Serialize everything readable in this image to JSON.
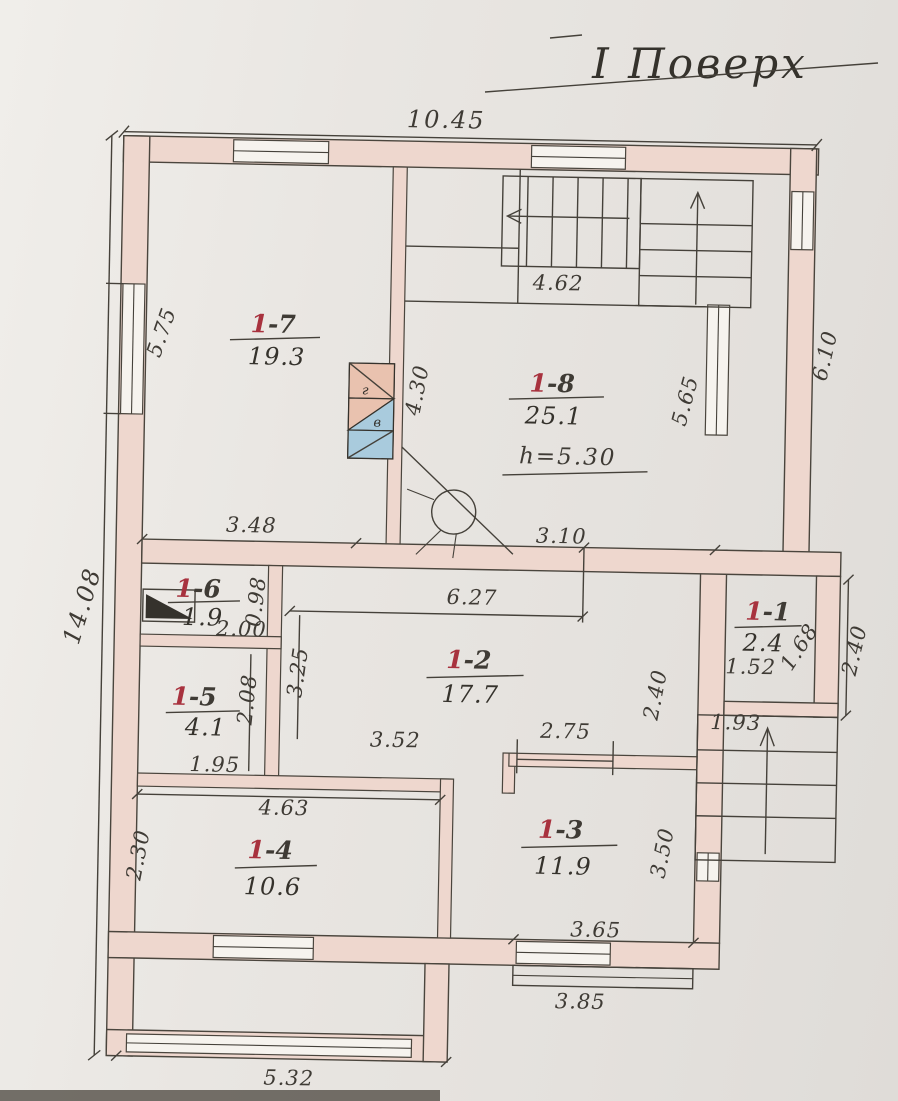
{
  "title": "І Поверх",
  "colors": {
    "paper": "#e9e6e2",
    "wall_fill": "#eed7ce",
    "ink": "#3f3b35",
    "room_number_red": "#a8323e",
    "flue_pink": "#e9c2af",
    "flue_blue": "#a9cbdd"
  },
  "rooms": [
    {
      "name": "room-1-7",
      "num_red": "1",
      "num_rest": "-7",
      "area": "19.3"
    },
    {
      "name": "room-1-8",
      "num_red": "1",
      "num_rest": "-8",
      "area": "25.1",
      "note": "h=5.30"
    },
    {
      "name": "room-1-6",
      "num_red": "1",
      "num_rest": "-6",
      "area": "1.9"
    },
    {
      "name": "room-1-2",
      "num_red": "1",
      "num_rest": "-2",
      "area": "17.7"
    },
    {
      "name": "room-1-1",
      "num_red": "1",
      "num_rest": "-1",
      "area": "2.4"
    },
    {
      "name": "room-1-5",
      "num_red": "1",
      "num_rest": "-5",
      "area": "4.1"
    },
    {
      "name": "room-1-4",
      "num_red": "1",
      "num_rest": "-4",
      "area": "10.6"
    },
    {
      "name": "room-1-3",
      "num_red": "1",
      "num_rest": "-3",
      "area": "11.9"
    }
  ],
  "dims": {
    "overall_width": "10.45",
    "overall_height": "14.08",
    "left_upper": "5.75",
    "stair_hall": "4.62",
    "wall_7_8": "4.30",
    "right_inner": "5.65",
    "right_outer": "6.10",
    "hall_top_left": "3.48",
    "hall_top_right": "3.10",
    "room2_width": "6.27",
    "room6_width": "2.00",
    "room6_door": "0.98",
    "room2_left": "3.25",
    "room5_height": "2.08",
    "room5_width": "1.95",
    "room2_bottom_left": "3.52",
    "room2_bottom_right": "2.75",
    "room2_right": "2.40",
    "vest_width": "1.52",
    "vest_depth": "1.68",
    "vest_right": "2.40",
    "ext_stair": "1.93",
    "room4_top": "4.63",
    "room4_left": "2.30",
    "room3_right": "3.50",
    "room3_bottom": "3.65",
    "step_bottom": "3.85",
    "porch_bottom": "5.32"
  },
  "flue": {
    "top_label": "г",
    "mid_label": "в"
  }
}
